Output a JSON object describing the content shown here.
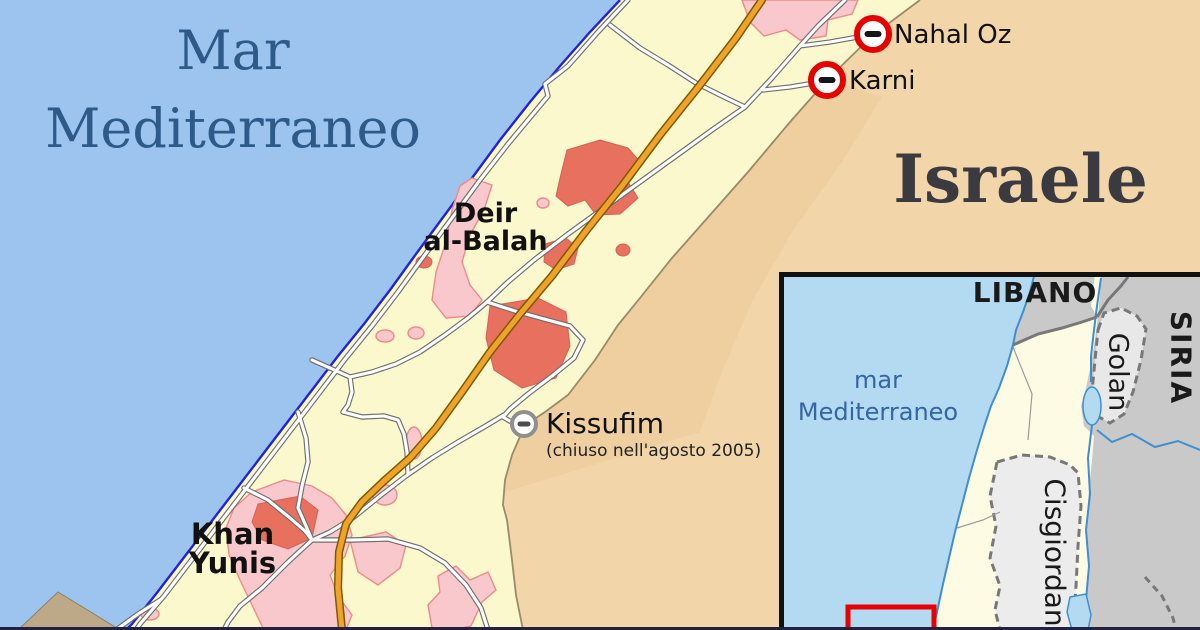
{
  "main_map": {
    "sea_label": "Mar Mediterraneo",
    "sea_label_display": "Mar\nMediterraneo",
    "israel_label": "Israele",
    "cities": [
      {
        "name": "Deir al-Balah",
        "display": "Deir\nal-Balah"
      },
      {
        "name": "Khan Yunis",
        "display": "Khan\nYunis"
      }
    ],
    "crossings": [
      {
        "name": "Nahal Oz",
        "icon": "closed-crossing-icon",
        "ring_color": "#e60000"
      },
      {
        "name": "Karni",
        "icon": "closed-crossing-icon",
        "ring_color": "#e60000"
      },
      {
        "name": "Kissufim",
        "note": "(chiuso nell'agosto 2005)",
        "icon": "closed-crossing-icon-gray",
        "ring_color": "#8f8f8f"
      }
    ]
  },
  "inset_map": {
    "labels": {
      "lebanon": "LIBANO",
      "syria": "SIRIA",
      "golan": "Golan",
      "west_bank": "Cisgiordania",
      "sea": "mar\nMediterraneo"
    }
  },
  "colors": {
    "sea": "#9cc4ef",
    "sea_label_text": "#2d5a88",
    "gaza_land": "#fbf8cd",
    "israel_land": "#f2d6aa",
    "border_zone": "#eac795",
    "urban_pink": "#f9c8cd",
    "urban_red": "#e8705f",
    "main_road": "#f0a32a",
    "road_casing": "#6f6f6f",
    "coast_line": "#2323d6",
    "dune": "#bda887",
    "crossing_ring_red": "#e60000",
    "crossing_ring_gray": "#8f8f8f",
    "inset_sea": "#b4daf2",
    "inset_israel": "#fdfbe4",
    "inset_neighbors": "#c9c9c9",
    "inset_occupied_gray": "#ececec",
    "inset_water_line": "#3d8fd1",
    "inset_border_gray": "#787878",
    "view_rect_red": "#e90000",
    "inset_sea_label_text": "#3465a4"
  }
}
